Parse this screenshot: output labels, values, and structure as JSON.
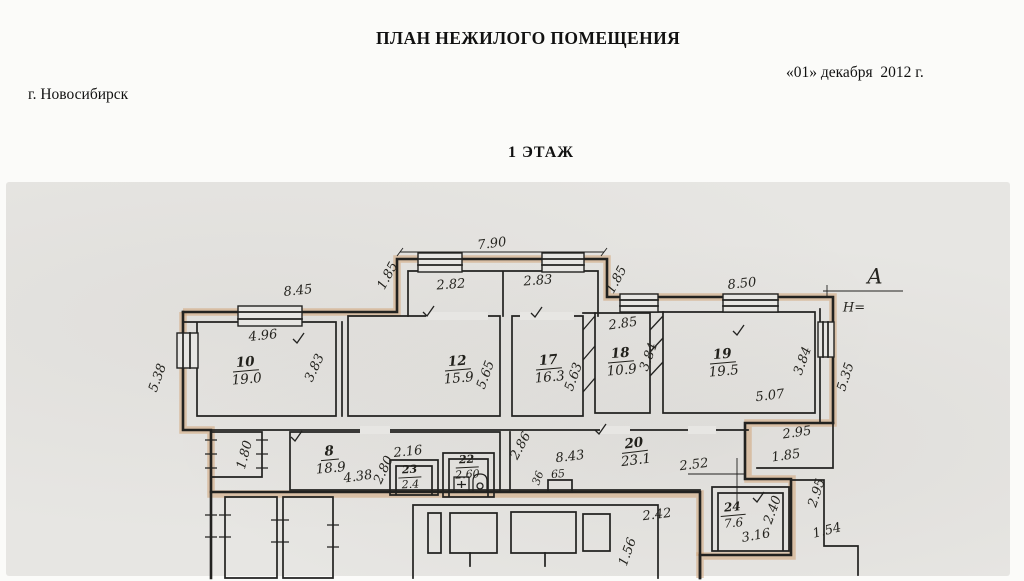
{
  "header": {
    "title": "ПЛАН НЕЖИЛОГО ПОМЕЩЕНИЯ",
    "date": "«01» декабря  2012 г.",
    "city": "г. Новосибирск",
    "floor": "1 ЭТАЖ"
  },
  "plan": {
    "colors": {
      "ink": "#222220",
      "highlight": "#d2a87e",
      "paper": "#fbfbf9",
      "scan_background": "#e7e6e3"
    },
    "rooms": [
      {
        "number": "10",
        "area": "19.0",
        "x": 246,
        "y": 371,
        "r": -5
      },
      {
        "number": "12",
        "area": "15.9",
        "x": 458,
        "y": 370,
        "r": -5
      },
      {
        "number": "17",
        "area": "16.3",
        "x": 549,
        "y": 369,
        "r": -5
      },
      {
        "number": "18",
        "area": "10.9",
        "x": 621,
        "y": 362,
        "r": -5
      },
      {
        "number": "19",
        "area": "19.5",
        "x": 723,
        "y": 363,
        "r": -5
      },
      {
        "number": "8",
        "area": "18.9",
        "x": 330,
        "y": 460,
        "r": -5
      },
      {
        "number": "23",
        "area": "2.4",
        "x": 410,
        "y": 477,
        "r": -3,
        "s": 11
      },
      {
        "number": "22",
        "area": "2.60",
        "x": 467,
        "y": 467,
        "r": -3,
        "s": 11
      },
      {
        "number": "20",
        "area": "23.1",
        "x": 635,
        "y": 452,
        "r": -7
      },
      {
        "number": "24",
        "area": "7.6",
        "x": 733,
        "y": 515,
        "r": -5,
        "s": 12
      }
    ],
    "dimensions": [
      {
        "t": "7.90",
        "x": 492,
        "y": 244,
        "r": -7
      },
      {
        "t": "1.85",
        "x": 388,
        "y": 276,
        "r": -62
      },
      {
        "t": "2.82",
        "x": 451,
        "y": 285,
        "r": -4
      },
      {
        "t": "2.83",
        "x": 538,
        "y": 281,
        "r": -4
      },
      {
        "t": "1.85",
        "x": 617,
        "y": 280,
        "r": -62
      },
      {
        "t": "8.45",
        "x": 298,
        "y": 291,
        "r": -6
      },
      {
        "t": "8.50",
        "x": 742,
        "y": 284,
        "r": -6
      },
      {
        "t": "А",
        "x": 875,
        "y": 277,
        "r": 0,
        "s": 21,
        "n": "axis-label"
      },
      {
        "t": "Н=",
        "x": 854,
        "y": 308,
        "r": 0,
        "s": 13,
        "n": "height-mark-label"
      },
      {
        "t": "5.38",
        "x": 158,
        "y": 378,
        "r": -70
      },
      {
        "t": "4.96",
        "x": 263,
        "y": 336,
        "r": -6
      },
      {
        "t": "3.83",
        "x": 315,
        "y": 368,
        "r": -65
      },
      {
        "t": "5.65",
        "x": 486,
        "y": 375,
        "r": -70
      },
      {
        "t": "5.63",
        "x": 574,
        "y": 377,
        "r": -70
      },
      {
        "t": "2.85",
        "x": 623,
        "y": 324,
        "r": -8
      },
      {
        "t": "3.84",
        "x": 649,
        "y": 357,
        "r": -70
      },
      {
        "t": "3.84",
        "x": 803,
        "y": 361,
        "r": -70
      },
      {
        "t": "5.07",
        "x": 770,
        "y": 396,
        "r": -7
      },
      {
        "t": "5.35",
        "x": 846,
        "y": 377,
        "r": -72
      },
      {
        "t": "1.80",
        "x": 245,
        "y": 455,
        "r": -75
      },
      {
        "t": "4.38",
        "x": 358,
        "y": 477,
        "r": -8
      },
      {
        "t": "2.16",
        "x": 408,
        "y": 452,
        "r": -6
      },
      {
        "t": "2.80",
        "x": 384,
        "y": 470,
        "r": -65
      },
      {
        "t": "2.86",
        "x": 521,
        "y": 446,
        "r": -62
      },
      {
        "t": "36",
        "x": 538,
        "y": 478,
        "r": -70,
        "s": 11
      },
      {
        "t": "8.43",
        "x": 570,
        "y": 457,
        "r": -7
      },
      {
        "t": "65",
        "x": 558,
        "y": 474,
        "r": -5,
        "s": 11
      },
      {
        "t": "2.52",
        "x": 694,
        "y": 465,
        "r": -7
      },
      {
        "t": "2.95",
        "x": 797,
        "y": 433,
        "r": -8
      },
      {
        "t": "1.85",
        "x": 786,
        "y": 456,
        "r": -8
      },
      {
        "t": "2.95",
        "x": 817,
        "y": 493,
        "r": -72
      },
      {
        "t": "1.54",
        "x": 827,
        "y": 531,
        "r": -14
      },
      {
        "t": "2.42",
        "x": 657,
        "y": 515,
        "r": -7
      },
      {
        "t": "3.16",
        "x": 756,
        "y": 536,
        "r": -10
      },
      {
        "t": "2.40",
        "x": 773,
        "y": 510,
        "r": -70
      },
      {
        "t": "1.56",
        "x": 628,
        "y": 552,
        "r": -70
      }
    ]
  }
}
